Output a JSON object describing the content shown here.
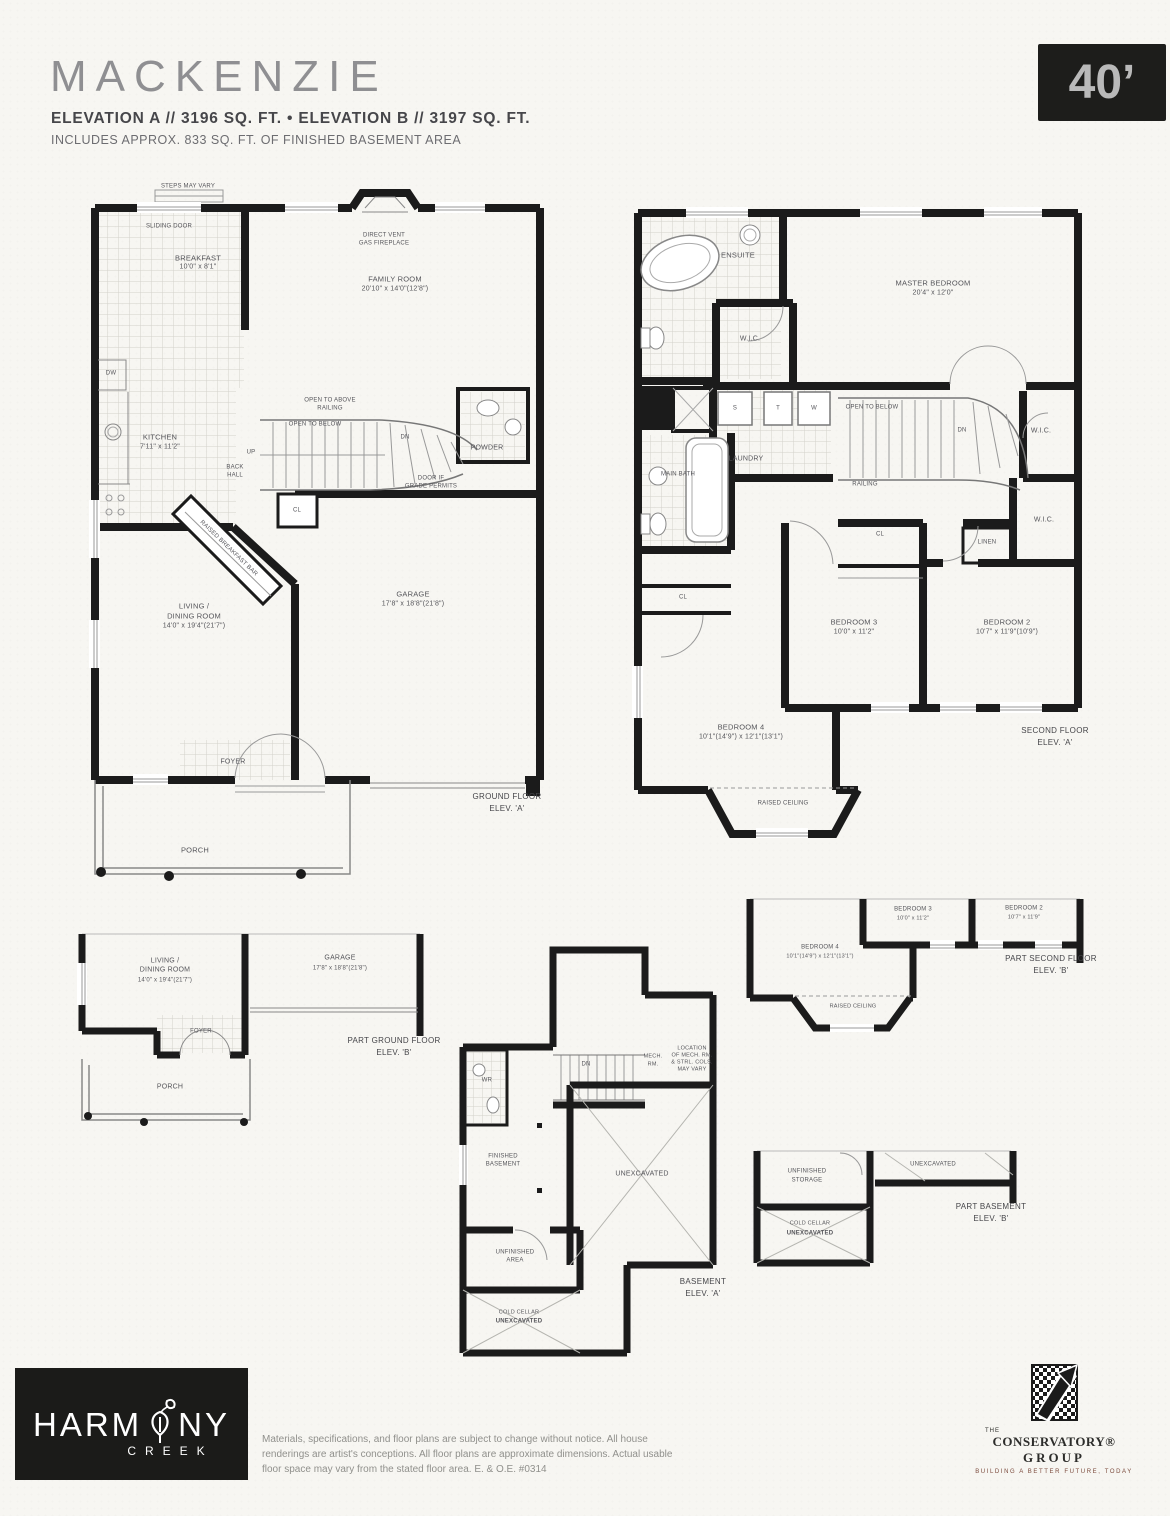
{
  "header": {
    "title": "MACKENZIE",
    "elevation_line": "ELEVATION A  //  3196 SQ. FT.  •  ELEVATION B  //  3197 SQ. FT.",
    "basement_note": "INCLUDES APPROX. 833 SQ. FT. OF FINISHED BASEMENT AREA",
    "lot_width_badge": "40’"
  },
  "ground_floor": {
    "caption_line1": "GROUND FLOOR",
    "caption_line2": "ELEV. 'A'",
    "steps_note": "STEPS MAY VARY",
    "sliding_door": "SLIDING DOOR",
    "fireplace_line1": "DIRECT VENT",
    "fireplace_line2": "GAS FIREPLACE",
    "breakfast_name": "BREAKFAST",
    "breakfast_dims": "10'0\" x 8'1\"",
    "family_name": "FAMILY ROOM",
    "family_dims": "20'10\" x 14'0\"(12'8\")",
    "kitchen_name": "KITCHEN",
    "kitchen_dims": "7'11\" x 11'2\"",
    "dw": "DW",
    "breakfast_bar": "RAISED BREAKFAST BAR",
    "up": "UP",
    "dn": "DN",
    "open_above_line1": "OPEN TO ABOVE",
    "open_above_line2": "RAILING",
    "open_below": "OPEN TO BELOW",
    "back_hall_line1": "BACK",
    "back_hall_line2": "HALL",
    "powder": "POWDER",
    "cl": "CL",
    "door_grade_line1": "DOOR IF",
    "door_grade_line2": "GRADE PERMITS",
    "living_line1": "LIVING /",
    "living_line2": "DINING ROOM",
    "living_dims": "14'0\" x 19'4\"(21'7\")",
    "garage_name": "GARAGE",
    "garage_dims": "17'8\" x 18'8\"(21'8\")",
    "foyer": "FOYER",
    "porch": "PORCH"
  },
  "second_floor": {
    "caption_line1": "SECOND FLOOR",
    "caption_line2": "ELEV. 'A'",
    "ensuite": "ENSUITE",
    "master_name": "MASTER BEDROOM",
    "master_dims": "20'4\" x 12'0\"",
    "wic": "W.I.C.",
    "wic2": "W.I.C.",
    "wic3": "W.I.C.",
    "laundry": "LAUNDRY",
    "s": "S",
    "t": "T",
    "w": "W",
    "open_below": "OPEN TO BELOW",
    "dn": "DN",
    "railing": "RAILING",
    "main_bath": "MAIN BATH",
    "linen": "LINEN",
    "cl": "CL",
    "cl2": "CL",
    "bedroom3_name": "BEDROOM 3",
    "bedroom3_dims": "10'0\" x 11'2\"",
    "bedroom2_name": "BEDROOM 2",
    "bedroom2_dims": "10'7\" x 11'9\"(10'9\")",
    "bedroom4_name": "BEDROOM 4",
    "bedroom4_dims": "10'1\"(14'9\") x 12'1\"(13'1\")",
    "raised_ceiling": "RAISED CEILING"
  },
  "part_ground_b": {
    "caption_line1": "PART GROUND FLOOR",
    "caption_line2": "ELEV. 'B'",
    "living_line1": "LIVING /",
    "living_line2": "DINING ROOM",
    "living_dims": "14'0\" x 19'4\"(21'7\")",
    "garage_name": "GARAGE",
    "garage_dims": "17'8\" x 18'8\"(21'8\")",
    "foyer": "FOYER",
    "porch": "PORCH"
  },
  "basement": {
    "caption_line1": "BASEMENT",
    "caption_line2": "ELEV. 'A'",
    "wr": "WR",
    "dn": "DN",
    "mech_line1": "MECH.",
    "mech_line2": "RM.",
    "note_line1": "LOCATION",
    "note_line2": "OF MECH. RM.",
    "note_line3": "& STRL. COLS.",
    "note_line4": "MAY VARY",
    "finished_line1": "FINISHED",
    "finished_line2": "BASEMENT",
    "unexcavated": "UNEXCAVATED",
    "unfinished_line1": "UNFINISHED",
    "unfinished_line2": "AREA",
    "cold_line1": "COLD CELLAR",
    "cold_line2": "UNEXCAVATED"
  },
  "part_second_b": {
    "caption_line1": "PART SECOND FLOOR",
    "caption_line2": "ELEV. 'B'",
    "bedroom3_name": "BEDROOM 3",
    "bedroom3_dims": "10'0\" x 11'2\"",
    "bedroom2_name": "BEDROOM 2",
    "bedroom2_dims": "10'7\" x 11'9\"",
    "bedroom4_name": "BEDROOM 4",
    "bedroom4_dims": "10'1\"(14'9\") x 12'1\"(13'1\")",
    "raised_ceiling": "RAISED CEILING"
  },
  "part_basement_b": {
    "caption_line1": "PART BASEMENT",
    "caption_line2": "ELEV. 'B'",
    "storage_line1": "UNFINISHED",
    "storage_line2": "STORAGE",
    "unexcavated": "UNEXCAVATED",
    "cold_line1": "COLD CELLAR",
    "cold_line2": "UNEXCAVATED"
  },
  "footer": {
    "harmony_left": "HARM",
    "harmony_right": "NY",
    "harmony_sub": "CREEK",
    "disclaimer": "Materials, specifications, and floor plans are subject to change without notice. All house renderings are artist's conceptions. All floor plans are approximate dimensions. Actual usable floor space may vary from the stated floor area. E. & O.E. #0314",
    "conservatory_the": "THE",
    "conservatory_name": "CONSERVATORY®",
    "conservatory_group": "GROUP",
    "conservatory_tagline": "BUILDING A BETTER FUTURE, TODAY"
  },
  "colors": {
    "wall": "#1b1b1b",
    "label": "#55555a",
    "badge_bg": "#1d1d1b",
    "tagline": "#7b4a3c"
  }
}
